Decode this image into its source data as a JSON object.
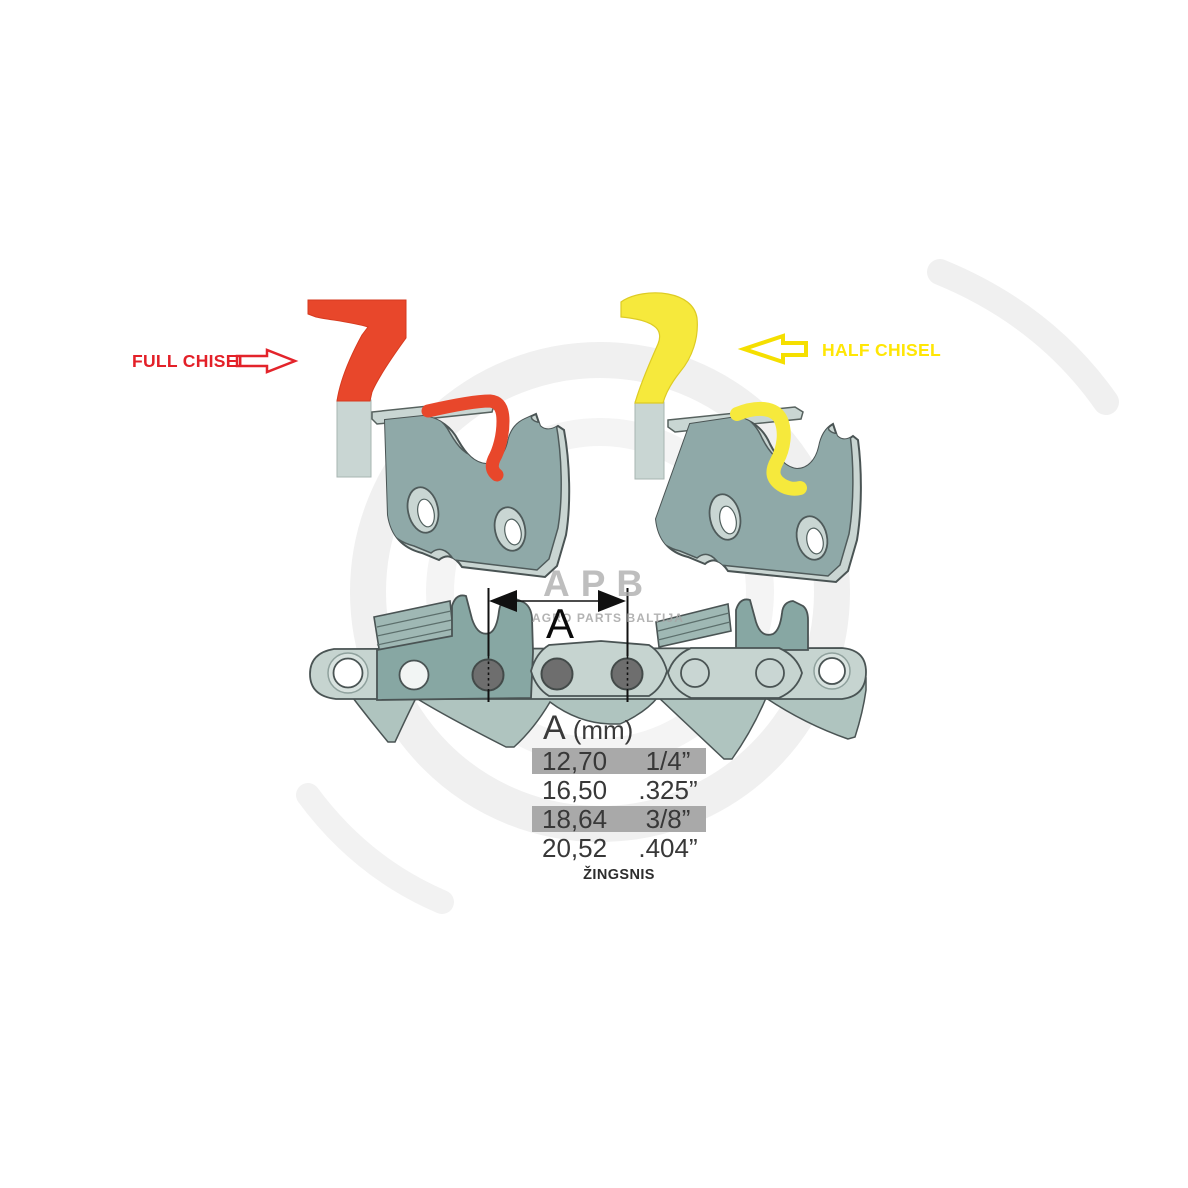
{
  "labels": {
    "full_chisel": "FULL CHISEL",
    "half_chisel": "HALF CHISEL"
  },
  "watermark": {
    "logo": "APB",
    "subtitle": "AGRO PARTS BALTIJA"
  },
  "dimension": {
    "label": "A"
  },
  "pitch_table": {
    "header": {
      "symbol": "A",
      "unit": "(mm)"
    },
    "rows": [
      {
        "mm": "12,70",
        "inches": "1/4”",
        "highlighted": true
      },
      {
        "mm": "16,50",
        "inches": ".325”",
        "highlighted": false
      },
      {
        "mm": "18,64",
        "inches": "3/8”",
        "highlighted": true
      },
      {
        "mm": "20,52",
        "inches": ".404”",
        "highlighted": false
      }
    ],
    "caption": "ŽINGSNIS"
  },
  "colors": {
    "full_chisel_accent": "#e8472b",
    "full_chisel_text": "#e32028",
    "half_chisel_accent": "#f6e93c",
    "half_chisel_text": "#ffe605",
    "link_body": "#8fa9a8",
    "link_rim": "#c9d5d2",
    "chain_strap": "#c6d4d0",
    "chain_drive": "#afc4bf",
    "rivet": "#6e6e6e",
    "outline": "#4a5454",
    "table_row_highlight": "#a9a9a9",
    "watermark_gray": "#aeaeae"
  }
}
